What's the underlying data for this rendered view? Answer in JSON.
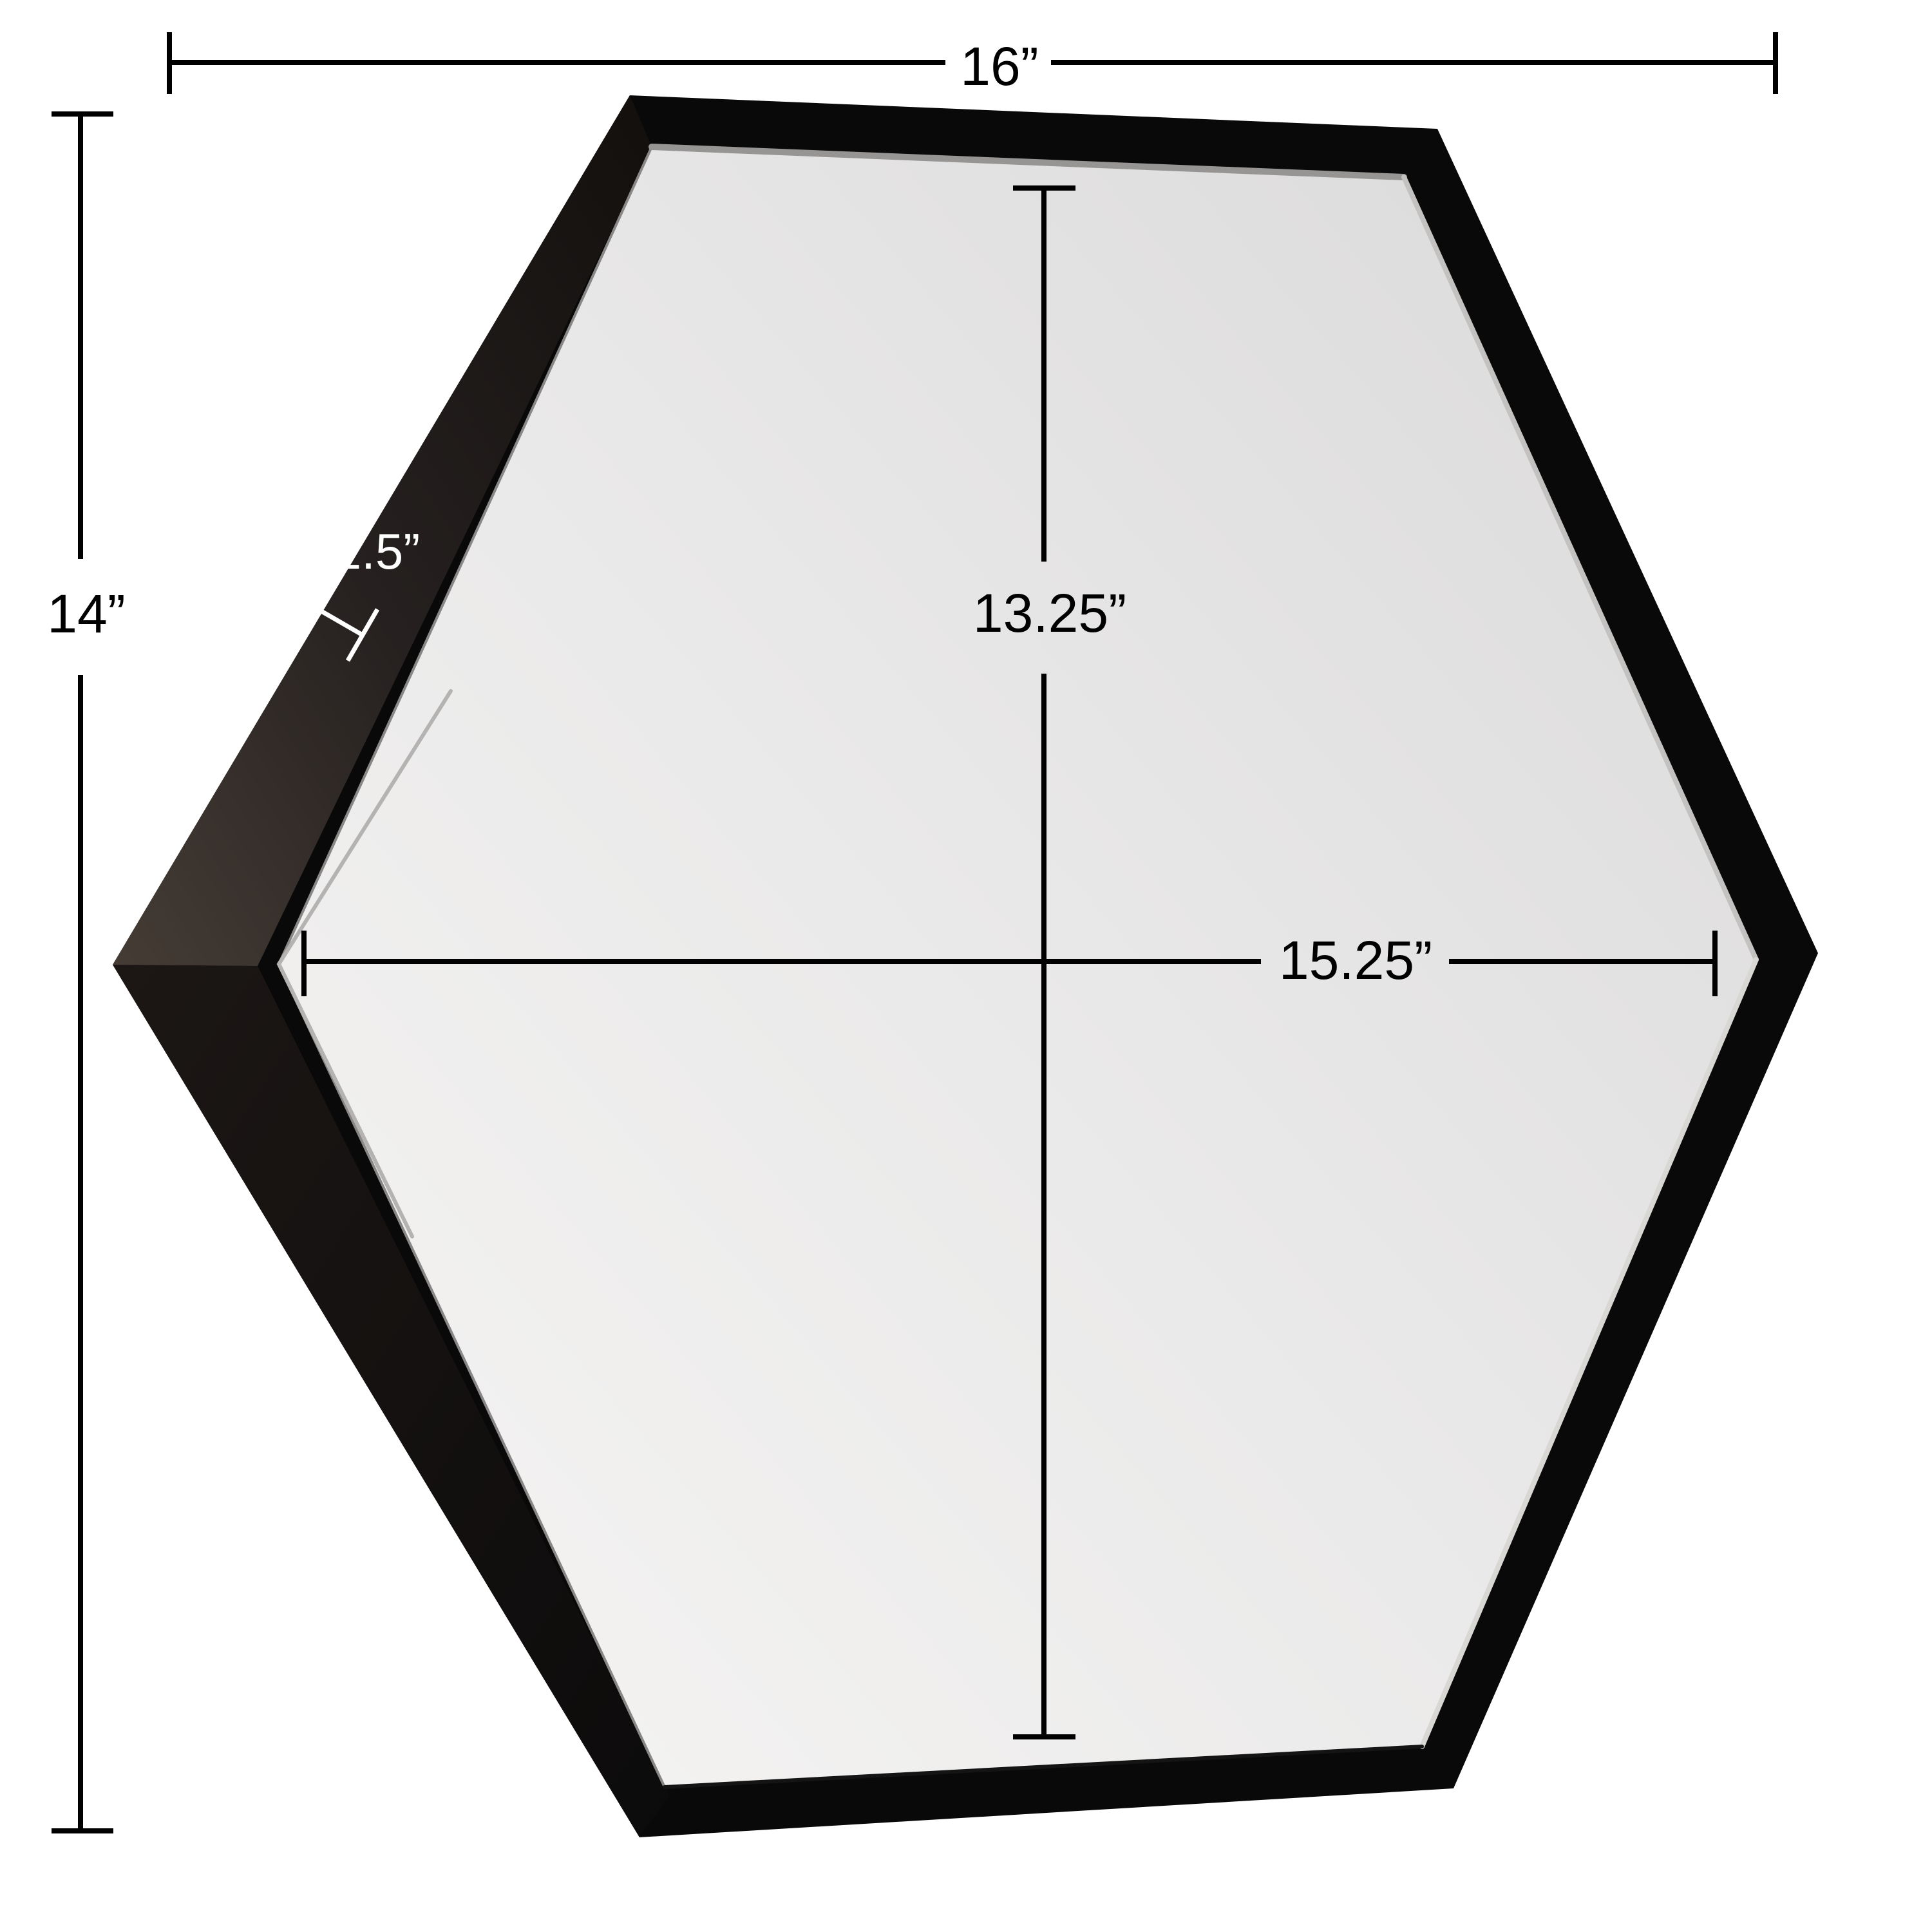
{
  "product": {
    "shape": "hexagon",
    "kind": "framed-wall-mirror",
    "frame_finish": "black"
  },
  "labels": {
    "overall_width": "16”",
    "overall_height": "14”",
    "frame_depth": "1.5”",
    "mirror_height": "13.25”",
    "mirror_width": "15.25”"
  },
  "colors": {
    "background": "#ffffff",
    "dimension_line": "#000000",
    "frame_front": "#0a0909",
    "frame_side_lit": "#3f3831",
    "frame_side_shadow": "#121010",
    "mirror_light": "#f4f3f2",
    "mirror_dark": "#dddcdd",
    "depth_annotation": "#ffffff"
  }
}
